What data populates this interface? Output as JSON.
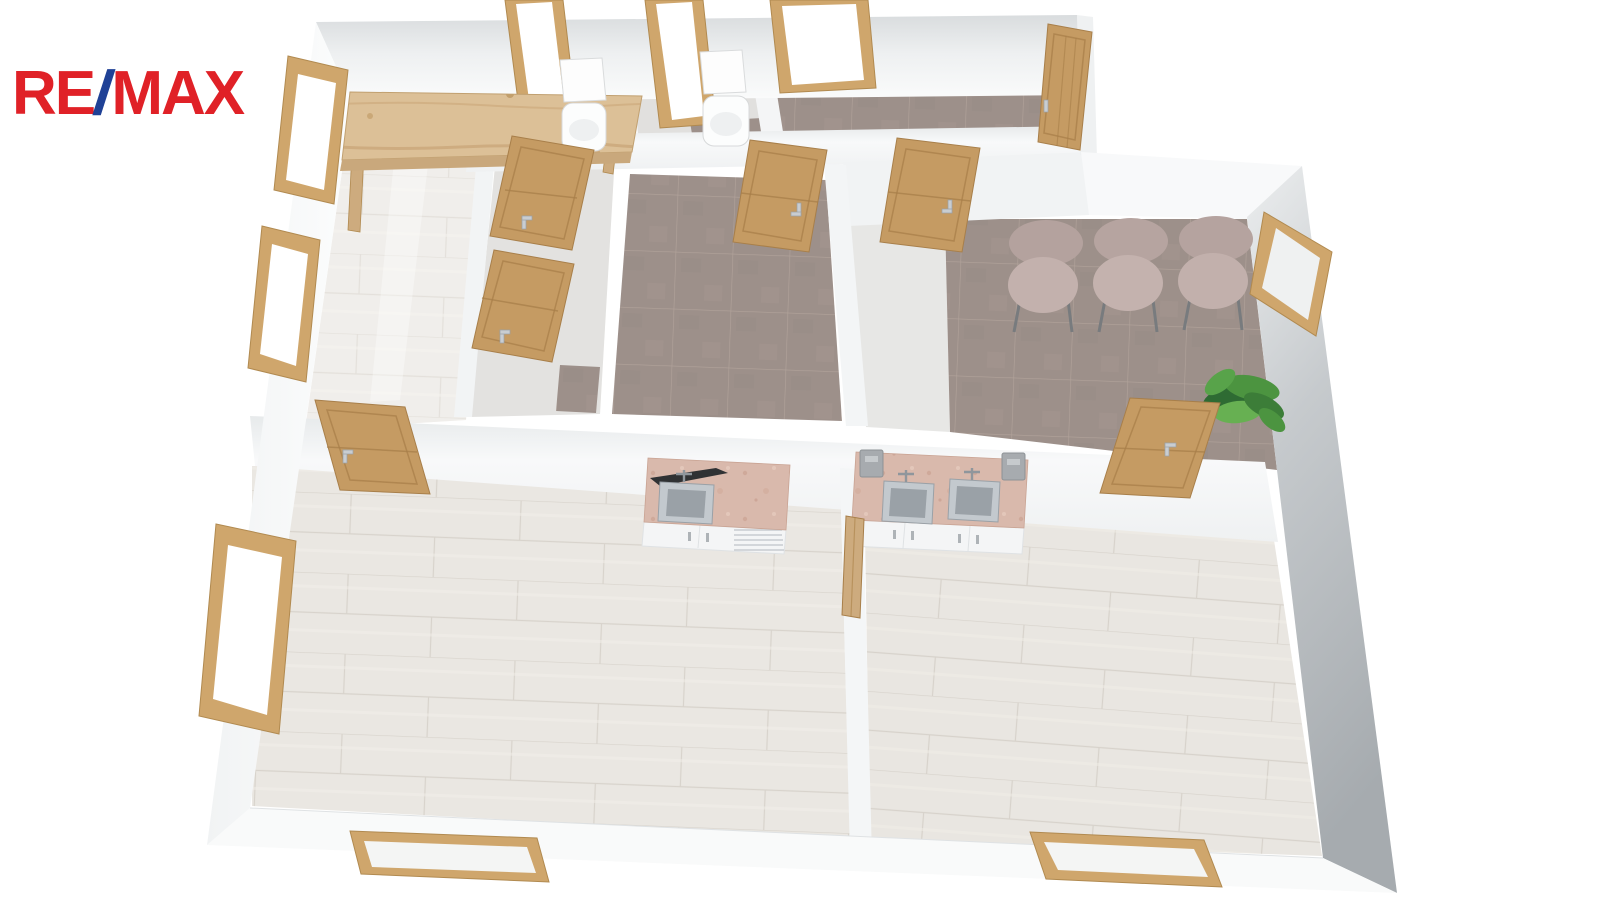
{
  "logo": {
    "re": "RE",
    "slash": "/",
    "max": "MAX",
    "red": "#e02127",
    "blue": "#1f4196"
  },
  "scene": {
    "kind": "isometric 3D dollhouse floor-plan render on white background",
    "walls": "white cut walls with light-gray top faces",
    "joinery_wood": "#cfa66c",
    "rooms": [
      {
        "name": "entry-hall",
        "floor": "light glossy tile",
        "features": [
          "rustic wooden reception table",
          "two windows on left wall"
        ]
      },
      {
        "name": "wc-1",
        "floor": "gray + brown tile",
        "features": [
          "toilet with cistern",
          "tall top window"
        ]
      },
      {
        "name": "wc-2",
        "floor": "gray + brown tile",
        "features": [
          "toilet with cistern",
          "tall top window"
        ]
      },
      {
        "name": "storage-closets",
        "floor": "light tile",
        "features": [
          "two oak doors opening from hallway wall"
        ]
      },
      {
        "name": "middle-room",
        "floor": "brown square tile",
        "features": [
          "oak door from top strip"
        ]
      },
      {
        "name": "vestibule",
        "floor": "brown square tile",
        "features": [
          "open entrance door at top-right",
          "wide top window"
        ]
      },
      {
        "name": "waiting-room",
        "floor": "brown square tile",
        "features": [
          "three blush upholstered chairs in a row",
          "window on right wall",
          "green potted plant in corner",
          "door to lower-right room"
        ]
      },
      {
        "name": "lower-left-room",
        "floor": "light wood-look plank tile",
        "features": [
          "single-sink cabinet with pink stone top",
          "window on left wall",
          "window on bottom wall",
          "door from hallway"
        ]
      },
      {
        "name": "lower-right-room",
        "floor": "light wood-look plank tile",
        "features": [
          "double-sink cabinet with pink stone top",
          "two gray wall dispensers",
          "window on bottom wall",
          "open door leaning on divider wall"
        ]
      }
    ],
    "counts": {
      "doors": 8,
      "windows": 9,
      "chairs": 3,
      "sinks": 3,
      "toilets": 2,
      "plants": 1
    },
    "palette": {
      "light_tile": "#eae7e2",
      "brown_tile": "#9d908a",
      "wood_door": "#c59b63",
      "wood_frame": "#cfa66c",
      "counter_stone": "#d9b9ac",
      "cabinet_white": "#f4f5f6",
      "steel_sink": "#b9bfc4",
      "chair_blush": "#bcaaa6",
      "plant_green": "#4c9440",
      "wall_gray": "#a9aeb2"
    }
  }
}
